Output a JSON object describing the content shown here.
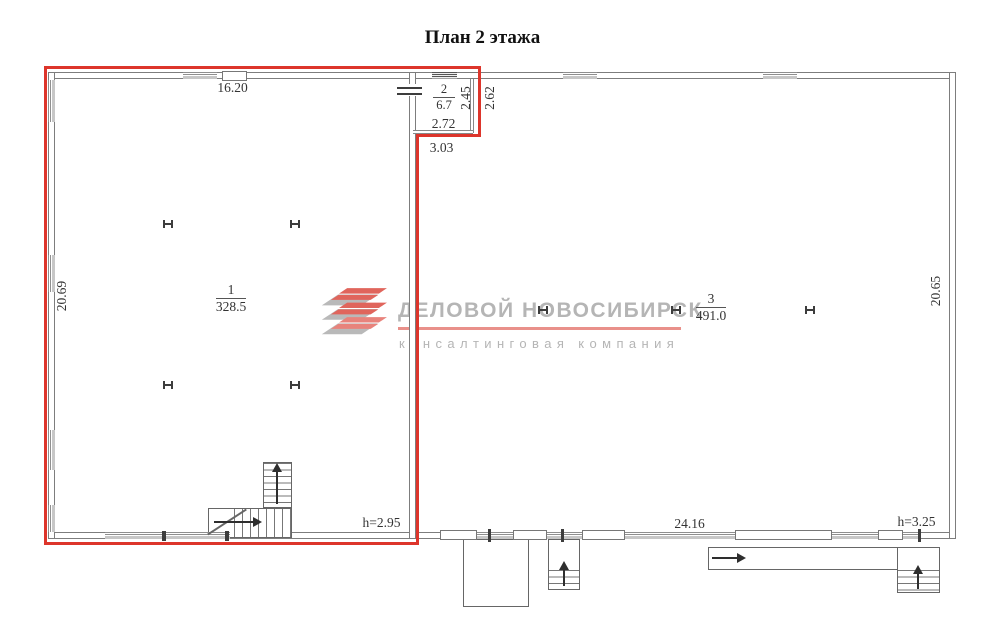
{
  "title": "План 2 этажа",
  "watermark": {
    "company": "ДЕЛОВОЙ НОВОСИБИРСК",
    "tagline": "консалтинговая компания"
  },
  "rooms": {
    "r1": {
      "number": "1",
      "area": "328.5"
    },
    "r2": {
      "number": "2",
      "area": "6.7"
    },
    "r3": {
      "number": "3",
      "area": "491.0"
    }
  },
  "dims": {
    "top_width": "16.20",
    "left_height": "20.69",
    "room2_height_inner": "2.45",
    "room2_height_outer": "2.62",
    "room2_width_inner": "2.72",
    "room2_width_outer": "3.03",
    "bottom_width": "24.16",
    "right_height": "20.65",
    "ceiling_left": "h=2.95",
    "ceiling_right": "h=3.25"
  },
  "colors": {
    "selection_outline": "#dd352b",
    "walls": "#7d7d7d",
    "watermark_text": "#b5b5b5",
    "watermark_accent": "#e9908a",
    "logo_red": "#e0655c",
    "logo_gray": "#b9b9b9"
  }
}
